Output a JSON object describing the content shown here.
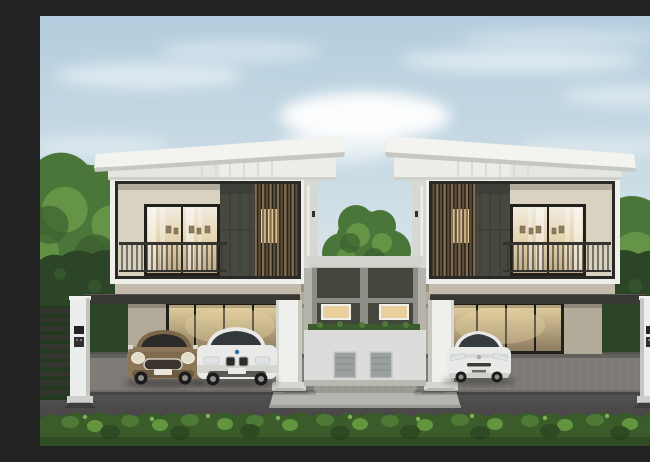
{
  "scene": {
    "description": "3D architectural rendering of two mirrored modern two-storey twin houses with carports, three parked cars, a central service wall with lit windows, white gate posts, dark gates, garden trees, boundary hedges and a front shrub hedge under a hazy blue sky with wispy clouds",
    "objects": {
      "left_house": "two-storey house with balcony, timber slat screen and carport",
      "right_house": "mirrored twin of the left house",
      "center_wall": "shared service wall with two lit windows and two meter boxes",
      "car_1": "bronze mini hatchback",
      "car_2": "white sedan",
      "car_3": "white hybrid hatchback",
      "front_hedge": "low green shrub hedge along the road",
      "gates": "dark slatted entrance gates with white intercom posts",
      "trees": "garden trees behind the boundary hedges"
    }
  },
  "colors": {
    "sky_top": "#b3cdde",
    "sky_mid": "#d3e1e7",
    "sky_low": "#ebefed",
    "cloud": "#ffffff",
    "roof_white": "#f3f4f0",
    "roof_shade": "#c6c7c1",
    "fascia": "#edeeea",
    "fascia_shade": "#e4e6e1",
    "groove": "#d5d6d0",
    "wall_white": "#efefeb",
    "wall_shade": "#c9c9c3",
    "side_wall": "#d8d8d3",
    "side_wall_low": "#b4b4ad",
    "frame_dark": "#2a2925",
    "cream": "#d9d2c0",
    "cream_shade": "#b3ab9a",
    "cream_strip": "#c3bbab",
    "olive": "#474940",
    "olive_dark": "#3a3c34",
    "slat_bg": "#211e19",
    "slat_a": "#846f50",
    "slat_b": "#5f4e39",
    "lit_window": "#e8cf9b",
    "railing": "#34332e",
    "glass_frame": "#21201c",
    "curtain": "#f0ebe0",
    "glow_mid": "#e6d6b2",
    "glow_lo": "#bfab89",
    "gar_hi": "#e3cf9f",
    "gar_lo": "#8d7c61",
    "interior_wall": "#e9ddc2",
    "pic_frame": "#8c7c60",
    "beam": "#393834",
    "beam_hi": "#57554f",
    "paving": "#7f7c78",
    "paving_dark": "#5d5a56",
    "speck_a": "#6b6864",
    "speck_b": "#999691",
    "road_hi": "#5a5757",
    "road_lo": "#383637",
    "walkway": "#b4b5af",
    "stone": "#9b9a93",
    "center_cap": "#d2d3cd",
    "center_wall": "#44453d",
    "center_trim": "#8e8e88",
    "center_lower": "#dcdcda",
    "meter": "#9aa09f",
    "meter_edge": "#c6cbca",
    "planter": "#3a5c2c",
    "hedge_wall": "#2c4526",
    "hedge_base": "#3a5c2b",
    "hedge_a": "#4e7a36",
    "hedge_b": "#63953f",
    "hedge_dark": "#2d4a22",
    "hedge_hi": "#7fb256",
    "tree_main": "#4b7639",
    "tree_hi": "#6b9c4a",
    "tree_dark": "#3c602f",
    "trunk": "#584838",
    "gate_slat": "#35352f",
    "gate_bg": "#243a1f",
    "post_white": "#eceded",
    "post_shade": "#c4c5c1",
    "device_a": "#23231f",
    "device_b": "#30302c",
    "mini_body": "#8d7557",
    "mini_dark": "#6e5a42",
    "mini_roof": "#7c6749",
    "chrome": "#cfcabe",
    "car_white": "#e9e9e7",
    "car_white_shade": "#cfcfcb",
    "win_dark": "#32383c",
    "win_mini": "#2a2a28",
    "light_warm": "#e3ddcb",
    "light_cool": "#dfe3e6",
    "wheel": "#1b1b1b",
    "hub": "#8f8f8c"
  }
}
